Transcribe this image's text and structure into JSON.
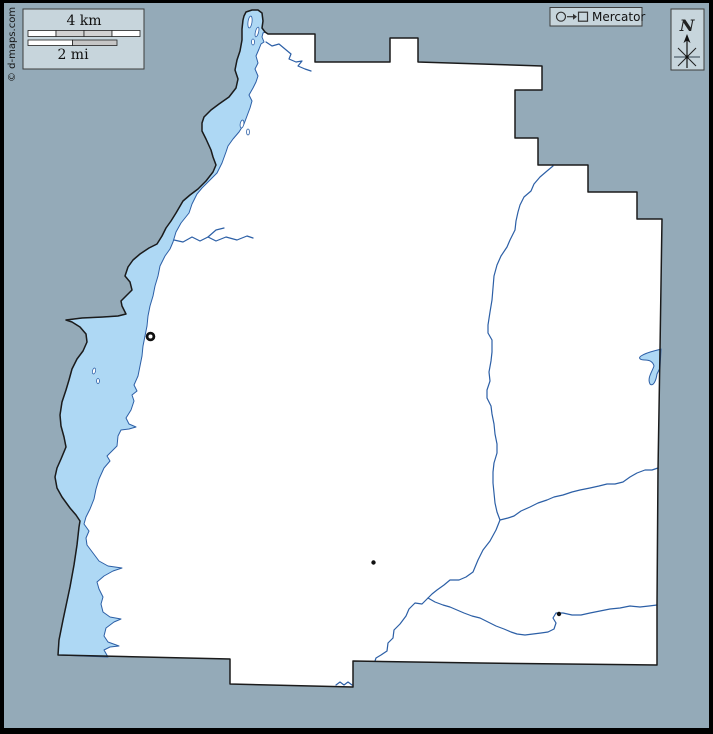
{
  "map": {
    "kind": "blank-outline-county-map",
    "attribution": "© d-maps.com",
    "scale_bar": {
      "km_label": "4 km",
      "mi_label": "2 mi",
      "km_segments": 4,
      "mi_segments": 2
    },
    "projection": {
      "label": "Mercator",
      "symbol_icons": [
        "circle-outline-icon",
        "right-arrow-icon",
        "square-outline-icon"
      ]
    },
    "compass": {
      "label": "N",
      "icon": "north-arrow-star-icon"
    },
    "colors": {
      "background": "#94aab8",
      "land": "#ffffff",
      "boundary": "#1b1b1b",
      "water_fill": "#aed8f4",
      "water_stroke": "#2c5fa6",
      "stream": "#2c5fa6",
      "legend_fill": "#c7d5dc",
      "frame": "#000000"
    },
    "markers": [
      {
        "type": "ring",
        "x": 150.5,
        "y": 336.5
      },
      {
        "type": "dot",
        "x": 373.5,
        "y": 562.5
      },
      {
        "type": "dot",
        "x": 559,
        "y": 614
      }
    ]
  }
}
